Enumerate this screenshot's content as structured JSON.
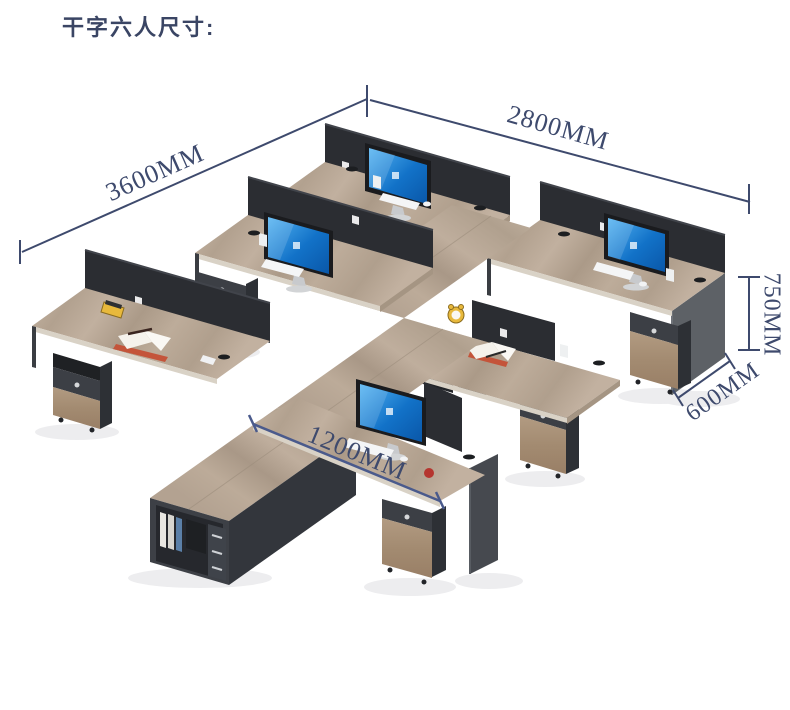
{
  "title": "干字六人尺寸:",
  "dimensions": {
    "top_left": {
      "label": "3600MM"
    },
    "top_right": {
      "label": "2800MM"
    },
    "desk_height": {
      "label": "750MM"
    },
    "desk_depth": {
      "label": "600MM"
    },
    "desk_width": {
      "label": "1200MM"
    }
  },
  "colors": {
    "annotation_navy": "#3e4a6d",
    "desk_width_line_blue": "#4a5a8c",
    "desk_wood": "#b5a493",
    "cabinet_wood": "#a8917a",
    "panel_dark": "#2b2d32",
    "side_gray": "#5d6166",
    "screen_blue": "#1272c8",
    "cup_red": "#b5352f",
    "clock_yellow": "#e8b93c"
  }
}
